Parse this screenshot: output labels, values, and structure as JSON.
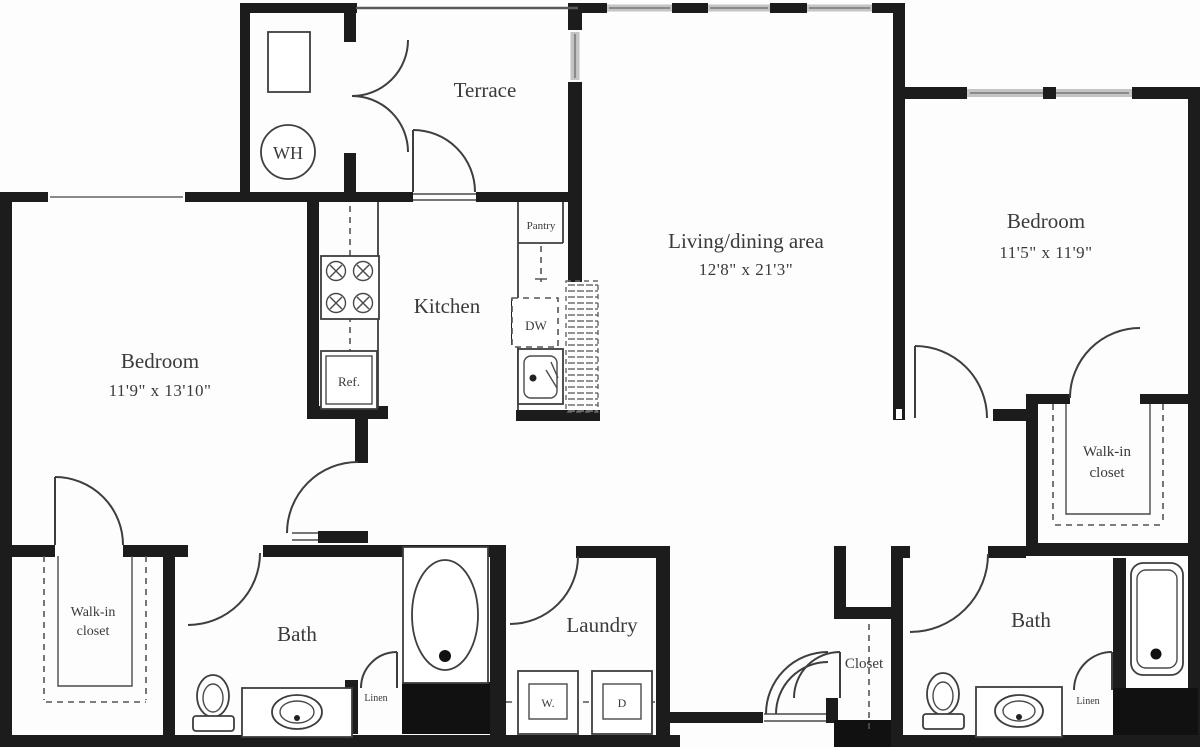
{
  "rooms": {
    "terrace": {
      "label": "Terrace"
    },
    "bedroom_left": {
      "label": "Bedroom",
      "dims": "11'9\" x 13'10\""
    },
    "bedroom_right": {
      "label": "Bedroom",
      "dims": "11'5\" x 11'9\""
    },
    "living_dining": {
      "label": "Living/dining area",
      "dims": "12'8\" x 21'3\""
    },
    "kitchen": {
      "label": "Kitchen"
    },
    "laundry": {
      "label": "Laundry"
    },
    "bath_left": {
      "label": "Bath"
    },
    "bath_right": {
      "label": "Bath"
    },
    "walkin_closet_left": {
      "line1": "Walk-in",
      "line2": "closet"
    },
    "walkin_closet_right": {
      "line1": "Walk-in",
      "line2": "closet"
    },
    "hall_closet": {
      "label": "Closet"
    }
  },
  "fixtures": {
    "water_heater": "WH",
    "pantry": "Pantry",
    "dishwasher": "DW",
    "refrigerator": "Ref.",
    "washer": "W.",
    "dryer": "D",
    "linen_left": "Linen",
    "linen_right": "Linen"
  },
  "colors": {
    "wall": "#1c1c1c",
    "line": "#3e3e3e",
    "text": "#3a3a3a",
    "window": "#c4c4c4",
    "background": "#fdfdfd"
  }
}
